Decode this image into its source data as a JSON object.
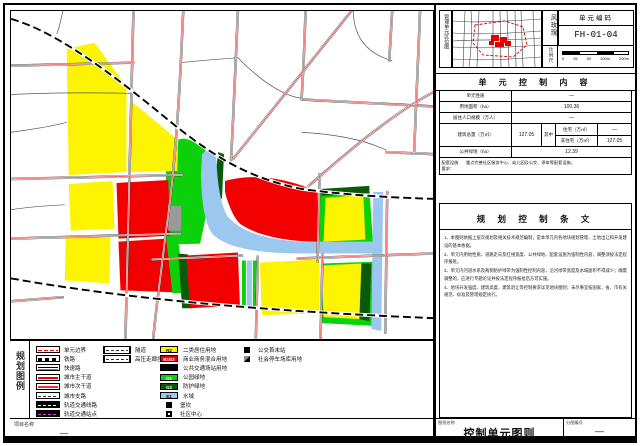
{
  "header": {
    "location_map_label": "管理单元区位图",
    "wind_rose_label": "风玫瑰",
    "scale_label": "比例尺",
    "scale_ticks": [
      "0",
      "25",
      "50",
      "100m",
      "200m"
    ],
    "unit_code_label": "单元编码",
    "unit_code": "FH-01-04"
  },
  "control_table": {
    "title": "单 元 控 制 内 容",
    "rows": [
      {
        "label": "单元性质",
        "value": "—"
      },
      {
        "label": "用地面积（ha）",
        "value": "100.36"
      },
      {
        "label": "居住人口规模（万人）",
        "value": "—"
      },
      {
        "label": "公共绿地（ha）",
        "value": "12.39"
      }
    ],
    "row_total": {
      "label": "建筑总量（万㎡）",
      "value": "127.05",
      "among_label": "其中",
      "sub": [
        {
          "label": "住宅（万㎡）",
          "value": "—"
        },
        {
          "label": "非住宅（万㎡）",
          "value": "127.05"
        }
      ]
    },
    "remark": {
      "label_line1": "配套设施",
      "label_line2": "要求：",
      "text": "重点完善社区服务中心、幼儿园及公交、停车等配套设施。"
    }
  },
  "provisions": {
    "title": "规 划 控 制 条 文",
    "items": [
      "1、本图则依据上层次规划及相关技术规范编制，是本单元内各地块规划管理、土地出让和开发建设的基本依据。",
      "2、单元内用地性质、道路走向及红线宽度、公共绿地、配套设施为强制性内容，调整须按法定程序报批。",
      "3、单元内河道水系及两侧防护绿带为强制性控制内容，沿河绿带宽度及水域面积不得减少；确需调整的，应进行专题论证并按法定程序报批后方可实施。",
      "4、地块开发强度、建筑高度、建筑退让等控制要求详见地块图则；未尽事宜按国家、省、市有关规范、标准及管理规定执行。"
    ]
  },
  "legend": {
    "title_vertical": "规划图例",
    "col1": [
      {
        "label": "单元边界"
      },
      {
        "label": "铁路"
      },
      {
        "label": "快速路"
      },
      {
        "label": "城市主干道"
      },
      {
        "label": "城市次干道"
      },
      {
        "label": "城市支路"
      },
      {
        "label": "轨道交通线路"
      },
      {
        "label": "轨道交通站点"
      }
    ],
    "col2": [
      {
        "label": "隧道"
      },
      {
        "label": "高压走廊控制线"
      }
    ],
    "col3": [
      {
        "code": "R2",
        "color": "#ffff00",
        "label": "二类居住用地"
      },
      {
        "code": "B1B2",
        "color": "#ff0000",
        "label": "商业商务混合用地"
      },
      {
        "code": "",
        "color": "#000000",
        "label": "公共交通场站用地"
      },
      {
        "code": "G1",
        "color": "#0ad10a",
        "label": "公园绿地"
      },
      {
        "code": "G2",
        "color": "#0a5a0a",
        "label": "防护绿地"
      },
      {
        "code": "E1",
        "color": "#9cc8f0",
        "label": "水域"
      },
      {
        "label": "堡坎"
      },
      {
        "label": "社区中心"
      }
    ],
    "col4": [
      {
        "label": "公交首末站"
      },
      {
        "label": "社会停车场库用地"
      }
    ]
  },
  "footer": {
    "project_name_label": "项目名称",
    "project_name": "—",
    "drawing_name_label": "图纸名称",
    "drawing_name": "控制单元图则",
    "sheet_no_label": "分图编号",
    "sheet_no": "—"
  }
}
